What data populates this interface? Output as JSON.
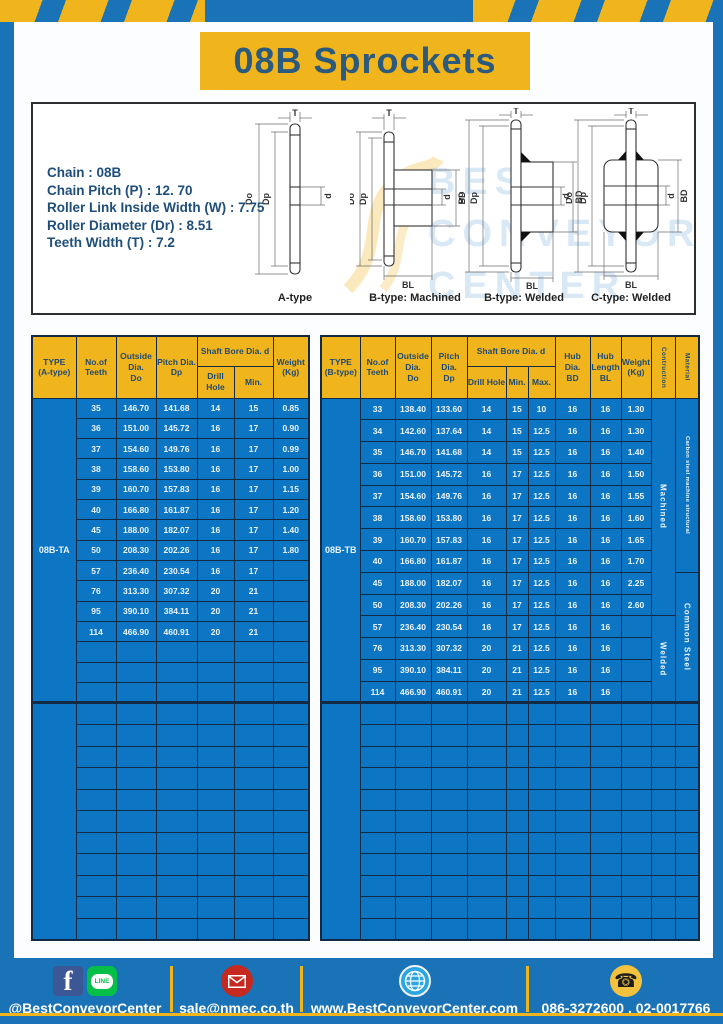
{
  "title": "08B Sprockets",
  "specs": [
    "Chain  : 08B",
    "Chain Pitch (P)  :  12. 70",
    "Roller Link Inside Width (W)  :  7.75",
    "Roller Diameter (Dr)  : 8.51",
    "Teeth Width (T)  :  7.2"
  ],
  "diagram_captions": [
    "A-type",
    "B-type: Machined",
    "B-type: Welded",
    "C-type: Welded"
  ],
  "dim_labels": {
    "T": "T",
    "Do": "Do",
    "Dp": "Dp",
    "d": "d",
    "BD": "BD",
    "BL": "BL"
  },
  "watermark": [
    "BEST",
    "CONVEYOR",
    "CENTER"
  ],
  "colors": {
    "frame_blue": "#1b73b7",
    "table_blue": "#0c76c5",
    "accent_yellow": "#f0b41c",
    "navy_text": "#1f4a73",
    "facebook_blue": "#3b5795",
    "line_green": "#06bf48",
    "mail_red": "#c5291f",
    "globe_blue": "#2aa7e0",
    "phone_yellow": "#f2c23e"
  },
  "tables": {
    "left": {
      "type_label": "08B-TA",
      "col_widths": [
        44,
        40,
        40,
        41,
        37,
        39,
        36
      ],
      "header_row1": [
        {
          "label": "TYPE\n(A-type)",
          "rowspan": 2
        },
        {
          "label": "No.of\nTeeth",
          "rowspan": 2
        },
        {
          "label": "Outside\nDia.\nDo",
          "rowspan": 2
        },
        {
          "label": "Pitch Dia.\nDp",
          "rowspan": 2
        },
        {
          "label": "Shaft Bore Dia. d",
          "colspan": 2
        },
        {
          "label": "Weight\n(Kg)",
          "rowspan": 2
        }
      ],
      "header_row2": [
        {
          "label": "Drill Hole"
        },
        {
          "label": "Min."
        }
      ],
      "rows": [
        [
          "35",
          "146.70",
          "141.68",
          "14",
          "15",
          "0.85"
        ],
        [
          "36",
          "151.00",
          "145.72",
          "16",
          "17",
          "0.90"
        ],
        [
          "37",
          "154.60",
          "149.76",
          "16",
          "17",
          "0.99"
        ],
        [
          "38",
          "158.60",
          "153.80",
          "16",
          "17",
          "1.00"
        ],
        [
          "39",
          "160.70",
          "157.83",
          "16",
          "17",
          "1.15"
        ],
        [
          "40",
          "166.80",
          "161.87",
          "16",
          "17",
          "1.20"
        ],
        [
          "45",
          "188.00",
          "182.07",
          "16",
          "17",
          "1.40"
        ],
        [
          "50",
          "208.30",
          "202.26",
          "16",
          "17",
          "1.80"
        ],
        [
          "57",
          "236.40",
          "230.54",
          "16",
          "17",
          ""
        ],
        [
          "76",
          "313.30",
          "307.32",
          "20",
          "21",
          ""
        ],
        [
          "95",
          "390.10",
          "384.11",
          "20",
          "21",
          ""
        ],
        [
          "114",
          "466.90",
          "460.91",
          "20",
          "21",
          ""
        ]
      ],
      "empty_rows_section1": 3,
      "empty_rows_section2": 11
    },
    "right": {
      "type_label": "08B-TB",
      "col_widths": [
        39,
        35,
        36,
        36,
        39,
        22,
        27,
        35,
        31,
        30,
        24,
        24
      ],
      "header_row1": [
        {
          "label": "TYPE\n(B-type)",
          "rowspan": 2
        },
        {
          "label": "No.of\nTeeth",
          "rowspan": 2
        },
        {
          "label": "Outside\nDia.\nDo",
          "rowspan": 2
        },
        {
          "label": "Pitch Dia.\nDp",
          "rowspan": 2
        },
        {
          "label": "Shaft Bore Dia. d",
          "colspan": 3
        },
        {
          "label": "Hub Dia.\nBD",
          "rowspan": 2
        },
        {
          "label": "Hub\nLength\nBL",
          "rowspan": 2
        },
        {
          "label": "Weight\n(Kg)",
          "rowspan": 2
        },
        {
          "label": "Contruction",
          "rowspan": 2,
          "vertical": true
        },
        {
          "label": "Material",
          "rowspan": 2,
          "vertical": true
        }
      ],
      "header_row2": [
        {
          "label": "Drill Hole"
        },
        {
          "label": "Min."
        },
        {
          "label": "Max."
        }
      ],
      "rows": [
        [
          "33",
          "138.40",
          "133.60",
          "14",
          "15",
          "10",
          "16",
          "16",
          "1.30"
        ],
        [
          "34",
          "142.60",
          "137.64",
          "14",
          "15",
          "12.5",
          "16",
          "16",
          "1.30"
        ],
        [
          "35",
          "146.70",
          "141.68",
          "14",
          "15",
          "12.5",
          "16",
          "16",
          "1.40"
        ],
        [
          "36",
          "151.00",
          "145.72",
          "16",
          "17",
          "12.5",
          "16",
          "16",
          "1.50"
        ],
        [
          "37",
          "154.60",
          "149.76",
          "16",
          "17",
          "12.5",
          "16",
          "16",
          "1.55"
        ],
        [
          "38",
          "158.60",
          "153.80",
          "16",
          "17",
          "12.5",
          "16",
          "16",
          "1.60"
        ],
        [
          "39",
          "160.70",
          "157.83",
          "16",
          "17",
          "12.5",
          "16",
          "16",
          "1.65"
        ],
        [
          "40",
          "166.80",
          "161.87",
          "16",
          "17",
          "12.5",
          "16",
          "16",
          "1.70"
        ],
        [
          "45",
          "188.00",
          "182.07",
          "16",
          "17",
          "12.5",
          "16",
          "16",
          "2.25"
        ],
        [
          "50",
          "208.30",
          "202.26",
          "16",
          "17",
          "12.5",
          "16",
          "16",
          "2.60"
        ],
        [
          "57",
          "236.40",
          "230.54",
          "16",
          "17",
          "12.5",
          "16",
          "16",
          ""
        ],
        [
          "76",
          "313.30",
          "307.32",
          "20",
          "21",
          "12.5",
          "16",
          "16",
          ""
        ],
        [
          "95",
          "390.10",
          "384.11",
          "20",
          "21",
          "12.5",
          "16",
          "16",
          ""
        ],
        [
          "114",
          "466.90",
          "460.91",
          "20",
          "21",
          "12.5",
          "16",
          "16",
          ""
        ]
      ],
      "construction": [
        {
          "label": "Machined",
          "span": 10
        },
        {
          "label": "Welded",
          "span": 4
        }
      ],
      "material": [
        {
          "label": "Carbon steel  machine structural",
          "span": 8
        },
        {
          "label": "Common Steel",
          "span": 6
        }
      ],
      "empty_rows_section1": 0,
      "empty_rows_section2": 11
    }
  },
  "footer": {
    "social_label": "@BestConveyorCenter",
    "email": "sale@nmec.co.th",
    "website": "www.BestConveyorCenter.com",
    "phones": "086-3272600 , 02-0017766",
    "facebook_glyph": "f",
    "line_badge": "LINE",
    "phone_glyph": "☎"
  }
}
